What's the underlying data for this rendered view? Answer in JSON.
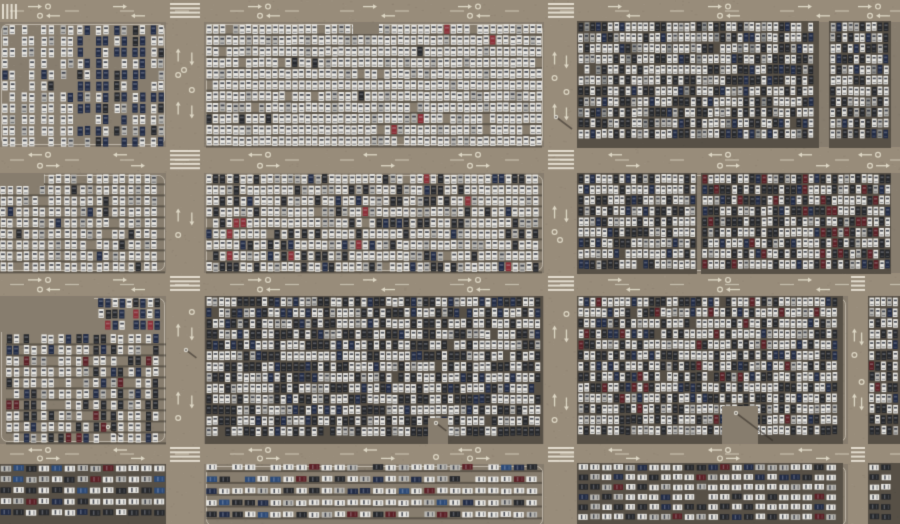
{
  "scene": {
    "description": "Aerial top-down drone photograph of a vast new-car storage parking lot: thousands of white, silver, black, navy and red vehicles parked in dense rows inside rectangular blocks separated by tan access roads with white lane arrows, circles, dashed lines and zebra crosswalks",
    "image_width": 900,
    "image_height": 524
  },
  "palette": {
    "ground": "#877d6e",
    "road": "#988c7a",
    "block_bg": "#575046",
    "marking": "#ded8c6",
    "shadow": "#3f3a33",
    "pole": "#d8d4ca",
    "car_white": "#e8e7e3",
    "car_silver": "#b9b8b4",
    "car_gray": "#90918f",
    "car_black": "#26282c",
    "car_navy": "#222c46",
    "car_blue": "#2d4b78",
    "car_red": "#8c3038",
    "car_maroon": "#5c2026",
    "window_on_light": "rgba(42,46,58,0.82)",
    "window_on_dark": "rgba(215,220,230,0.28)"
  },
  "roads": {
    "horizontal": [
      {
        "y": 0,
        "h": 22
      },
      {
        "y": 147,
        "h": 26
      },
      {
        "y": 273,
        "h": 23
      },
      {
        "y": 444,
        "h": 20
      }
    ],
    "vertical": [
      {
        "x": 166,
        "w": 38,
        "y0": 0,
        "y1": 524
      },
      {
        "x": 544,
        "w": 33,
        "y0": 0,
        "y1": 524
      },
      {
        "x": 848,
        "w": 20,
        "y0": 273,
        "y1": 524
      }
    ]
  },
  "border_cells": [
    {
      "x": 0,
      "y": 23,
      "w": 166,
      "h": 123
    },
    {
      "x": 205,
      "y": 23,
      "w": 339,
      "h": 123
    },
    {
      "x": 578,
      "y": 23,
      "w": 240,
      "h": 123
    },
    {
      "x": 829,
      "y": 23,
      "w": 63,
      "h": 123
    },
    {
      "x": 0,
      "y": 174,
      "w": 166,
      "h": 98
    },
    {
      "x": 205,
      "y": 174,
      "w": 339,
      "h": 98
    },
    {
      "x": 578,
      "y": 174,
      "w": 313,
      "h": 98
    },
    {
      "x": 0,
      "y": 297,
      "w": 166,
      "h": 146
    },
    {
      "x": 205,
      "y": 297,
      "w": 339,
      "h": 146
    },
    {
      "x": 578,
      "y": 297,
      "w": 269,
      "h": 146
    },
    {
      "x": 869,
      "y": 297,
      "w": 31,
      "h": 146
    },
    {
      "x": 0,
      "y": 465,
      "w": 166,
      "h": 62
    },
    {
      "x": 205,
      "y": 465,
      "w": 339,
      "h": 62
    },
    {
      "x": 578,
      "y": 465,
      "w": 269,
      "h": 62
    },
    {
      "x": 869,
      "y": 465,
      "w": 31,
      "h": 62
    }
  ],
  "zebras": [
    {
      "x": 170,
      "y": 3,
      "w": 30,
      "h": 17,
      "o": "v"
    },
    {
      "x": 170,
      "y": 150,
      "w": 30,
      "h": 20,
      "o": "v"
    },
    {
      "x": 170,
      "y": 276,
      "w": 30,
      "h": 17,
      "o": "v"
    },
    {
      "x": 170,
      "y": 447,
      "w": 30,
      "h": 15,
      "o": "v"
    },
    {
      "x": 548,
      "y": 3,
      "w": 26,
      "h": 17,
      "o": "v"
    },
    {
      "x": 548,
      "y": 150,
      "w": 26,
      "h": 20,
      "o": "v"
    },
    {
      "x": 548,
      "y": 276,
      "w": 26,
      "h": 17,
      "o": "v"
    },
    {
      "x": 548,
      "y": 447,
      "w": 26,
      "h": 15,
      "o": "v"
    },
    {
      "x": 851,
      "y": 276,
      "w": 14,
      "h": 17,
      "o": "v"
    },
    {
      "x": 851,
      "y": 447,
      "w": 14,
      "h": 15,
      "o": "v"
    },
    {
      "x": 2,
      "y": 4,
      "w": 17,
      "h": 15,
      "o": "h"
    }
  ],
  "v_marks": [
    {
      "rx": 166,
      "rw": 38,
      "ys": [
        55,
        108,
        215,
        330,
        398
      ]
    },
    {
      "rx": 544,
      "rw": 33,
      "ys": [
        58,
        110,
        212,
        332,
        400
      ]
    },
    {
      "rx": 848,
      "rw": 20,
      "ys": [
        335,
        400
      ]
    }
  ],
  "h_marks": [
    {
      "ry": 0,
      "rh": 22,
      "upper": "right",
      "xs": [
        35,
        120,
        255,
        370,
        465,
        615,
        715,
        805,
        865
      ]
    },
    {
      "ry": 147,
      "rh": 26,
      "upper": "left",
      "xs": [
        35,
        120,
        255,
        370,
        465,
        615,
        715,
        805,
        865
      ]
    },
    {
      "ry": 273,
      "rh": 23,
      "upper": "right",
      "xs": [
        35,
        120,
        255,
        370,
        465,
        615,
        715,
        805
      ]
    },
    {
      "ry": 444,
      "rh": 20,
      "upper": "left",
      "xs": [
        35,
        120,
        255,
        370,
        465,
        615,
        715,
        805
      ]
    }
  ],
  "blocks": [
    {
      "id": "A1a",
      "x": 2,
      "y": 25,
      "w": 73,
      "h": 122,
      "o": "v",
      "colPitch": 7.2,
      "rowPitch": 11.2,
      "density": 0.82,
      "pairGap": 5,
      "rowShadow": false,
      "dense": false,
      "mix": {
        "white": 78,
        "silver": 13,
        "black": 5,
        "navy": 4
      }
    },
    {
      "id": "A1b",
      "x": 77,
      "y": 25,
      "w": 91,
      "h": 122,
      "o": "v",
      "colPitch": 7.2,
      "rowPitch": 11.2,
      "density": 0.93,
      "pairGap": 4,
      "rowShadow": false,
      "dense": false,
      "mix": {
        "navy": 50,
        "white": 30,
        "black": 12,
        "silver": 8
      }
    },
    {
      "id": "A2",
      "x": 206,
      "y": 24,
      "w": 336,
      "h": 123,
      "o": "v",
      "colPitch": 6.6,
      "rowPitch": 11.2,
      "density": 0.95,
      "pairGap": 0,
      "rowShadow": true,
      "dense": false,
      "mix": {
        "white": 87,
        "silver": 10,
        "black": 2,
        "red": 1
      }
    },
    {
      "id": "A3",
      "x": 578,
      "y": 22,
      "w": 240,
      "h": 125,
      "o": "v",
      "colPitch": 5.9,
      "rowPitch": 10.7,
      "density": 0.99,
      "pairGap": 0,
      "rowShadow": false,
      "dense": true,
      "mix": {
        "white": 50,
        "black": 26,
        "silver": 10,
        "navy": 9,
        "gray": 5
      }
    },
    {
      "id": "A4",
      "x": 830,
      "y": 22,
      "w": 60,
      "h": 125,
      "o": "v",
      "colPitch": 5.9,
      "rowPitch": 10.7,
      "density": 0.99,
      "pairGap": 0,
      "rowShadow": false,
      "dense": true,
      "mix": {
        "white": 48,
        "black": 28,
        "silver": 9,
        "navy": 10,
        "gray": 5
      }
    },
    {
      "id": "B1",
      "x": 0,
      "y": 174,
      "w": 165,
      "h": 99,
      "o": "v",
      "colPitch": 7.0,
      "rowPitch": 11.0,
      "density": 0.96,
      "pairGap": 2,
      "rowShadow": true,
      "dense": false,
      "mix": {
        "white": 76,
        "silver": 13,
        "black": 8,
        "navy": 3
      }
    },
    {
      "id": "B2",
      "x": 206,
      "y": 174,
      "w": 336,
      "h": 99,
      "o": "v",
      "colPitch": 6.8,
      "rowPitch": 11.0,
      "density": 0.97,
      "pairGap": 0,
      "rowShadow": true,
      "dense": false,
      "mix": {
        "white": 64,
        "silver": 10,
        "black": 18,
        "navy": 5,
        "red": 3
      }
    },
    {
      "id": "B3a",
      "x": 578,
      "y": 174,
      "w": 118,
      "h": 99,
      "o": "v",
      "colPitch": 5.9,
      "rowPitch": 10.7,
      "density": 0.99,
      "pairGap": 0,
      "rowShadow": false,
      "dense": true,
      "mix": {
        "white": 56,
        "black": 24,
        "silver": 10,
        "navy": 10
      }
    },
    {
      "id": "B3b",
      "x": 702,
      "y": 174,
      "w": 188,
      "h": 99,
      "o": "v",
      "colPitch": 5.9,
      "rowPitch": 10.7,
      "density": 0.99,
      "pairGap": 0,
      "rowShadow": false,
      "dense": true,
      "mix": {
        "white": 44,
        "black": 30,
        "maroon": 8,
        "navy": 10,
        "silver": 8
      }
    },
    {
      "id": "C1a",
      "x": 98,
      "y": 298,
      "w": 68,
      "h": 33,
      "o": "v",
      "colPitch": 7.0,
      "rowPitch": 11.0,
      "density": 0.9,
      "pairGap": 0,
      "rowShadow": false,
      "dense": false,
      "mix": {
        "navy": 38,
        "white": 38,
        "black": 15,
        "red": 9
      }
    },
    {
      "id": "C1b",
      "x": 6,
      "y": 334,
      "w": 160,
      "h": 110,
      "o": "v",
      "colPitch": 7.2,
      "rowPitch": 11.0,
      "density": 0.89,
      "pairGap": 3,
      "rowShadow": true,
      "dense": false,
      "mix": {
        "white": 48,
        "black": 26,
        "navy": 13,
        "silver": 7,
        "maroon": 6
      }
    },
    {
      "id": "C2",
      "x": 206,
      "y": 297,
      "w": 336,
      "h": 146,
      "o": "v",
      "colPitch": 6.2,
      "rowPitch": 10.8,
      "density": 0.99,
      "pairGap": 0,
      "rowShadow": false,
      "dense": true,
      "mix": {
        "white": 50,
        "black": 33,
        "silver": 9,
        "navy": 8
      }
    },
    {
      "id": "C3",
      "x": 578,
      "y": 297,
      "w": 264,
      "h": 146,
      "o": "v",
      "colPitch": 5.9,
      "rowPitch": 10.7,
      "density": 0.99,
      "pairGap": 0,
      "rowShadow": false,
      "dense": true,
      "mix": {
        "white": 52,
        "black": 27,
        "silver": 8,
        "navy": 8,
        "maroon": 5
      }
    },
    {
      "id": "C4",
      "x": 869,
      "y": 297,
      "w": 31,
      "h": 146,
      "o": "v",
      "colPitch": 5.9,
      "rowPitch": 10.7,
      "density": 0.99,
      "pairGap": 0,
      "rowShadow": false,
      "dense": true,
      "mix": {
        "white": 50,
        "black": 28,
        "silver": 9,
        "navy": 8,
        "maroon": 5
      }
    },
    {
      "id": "D1",
      "x": 0,
      "y": 465,
      "w": 165,
      "h": 59,
      "o": "h",
      "colPitch": 12.8,
      "rowPitch": 11.0,
      "ch": 5.8,
      "density": 0.97,
      "pairGap": 0,
      "rowShadow": false,
      "dense": true,
      "mix": {
        "white": 50,
        "black": 20,
        "silver": 10,
        "maroon": 8,
        "navy": 7,
        "blue": 5
      }
    },
    {
      "id": "D2",
      "x": 206,
      "y": 464,
      "w": 336,
      "h": 60,
      "o": "h",
      "colPitch": 12.8,
      "rowPitch": 11.8,
      "ch": 5.6,
      "density": 0.96,
      "pairGap": 0,
      "rowShadow": true,
      "dense": false,
      "mix": {
        "white": 58,
        "silver": 12,
        "black": 12,
        "blue": 6,
        "maroon": 6,
        "navy": 6
      }
    },
    {
      "id": "D3",
      "x": 578,
      "y": 464,
      "w": 264,
      "h": 60,
      "o": "h",
      "colPitch": 11.8,
      "rowPitch": 9.9,
      "ch": 5.6,
      "density": 0.98,
      "pairGap": 0,
      "rowShadow": false,
      "dense": true,
      "mix": {
        "white": 50,
        "black": 25,
        "silver": 12,
        "navy": 8,
        "maroon": 5
      }
    },
    {
      "id": "D4",
      "x": 869,
      "y": 464,
      "w": 31,
      "h": 60,
      "o": "h",
      "colPitch": 11.8,
      "rowPitch": 9.9,
      "ch": 5.6,
      "density": 0.98,
      "pairGap": 0,
      "rowShadow": false,
      "dense": true,
      "mix": {
        "white": 50,
        "black": 25,
        "silver": 12,
        "navy": 8,
        "maroon": 5
      }
    }
  ],
  "empty_patches": [
    {
      "x": 353,
      "y": 24,
      "w": 26,
      "h": 10
    },
    {
      "x": 0,
      "y": 296,
      "w": 94,
      "h": 36
    },
    {
      "x": 722,
      "y": 406,
      "w": 36,
      "h": 38
    },
    {
      "x": 428,
      "y": 418,
      "w": 20,
      "h": 26
    },
    {
      "x": 0,
      "y": 174,
      "w": 44,
      "h": 12
    }
  ],
  "poles": [
    {
      "x": 556,
      "y": 117,
      "len": 20
    },
    {
      "x": 108,
      "y": 427,
      "len": 15
    },
    {
      "x": 436,
      "y": 423,
      "len": 13
    },
    {
      "x": 736,
      "y": 413,
      "len": 46
    },
    {
      "x": 186,
      "y": 350,
      "len": 13
    }
  ],
  "rings": [
    {
      "x": 436,
      "y": 457
    },
    {
      "x": 184,
      "y": 70
    },
    {
      "x": 560,
      "y": 240
    }
  ]
}
